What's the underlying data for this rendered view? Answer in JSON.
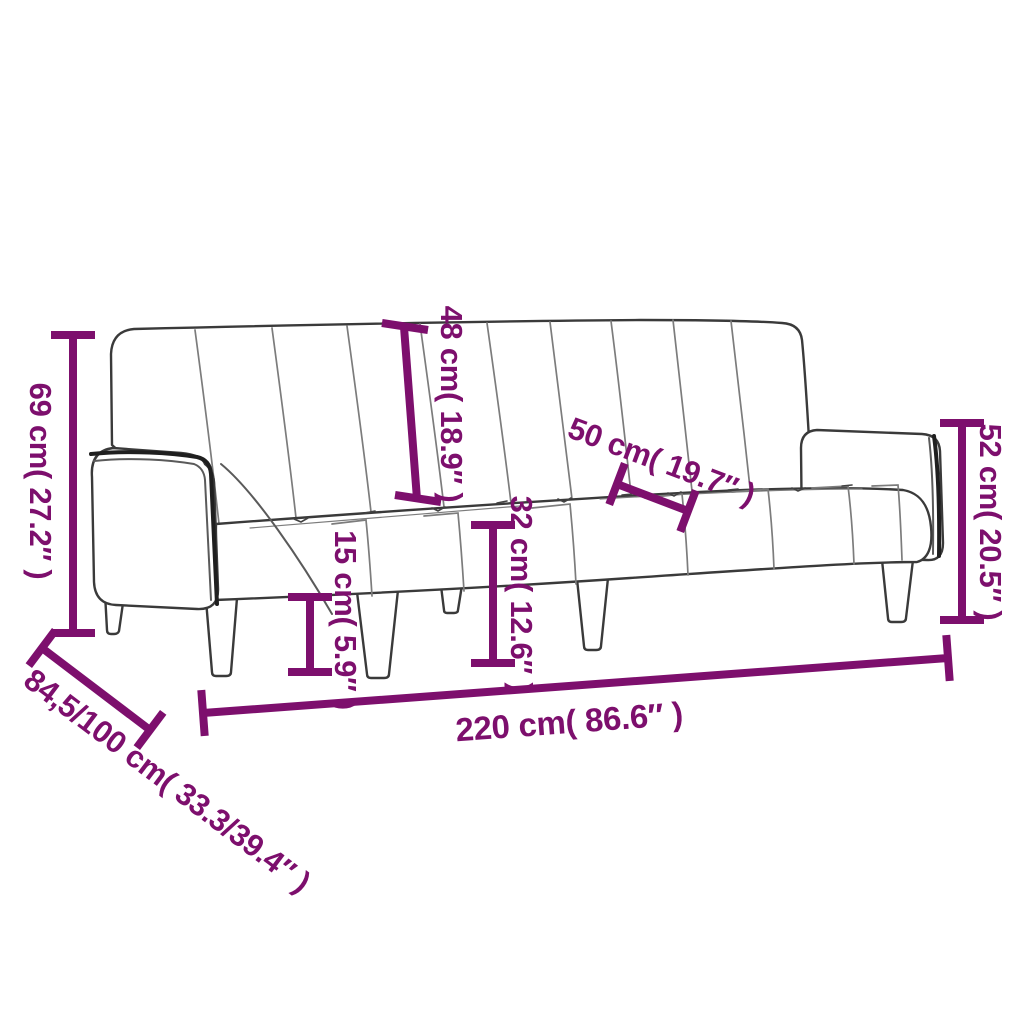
{
  "diagram": {
    "background": "#ffffff",
    "accent_color": "#7D0F6D",
    "sofa_outline_color": "#3a3a3a",
    "sofa_detail_color": "#7c7c7c"
  },
  "dimensions": {
    "dim_69": {
      "label": "69 cm( 27.2″ )"
    },
    "dim_48": {
      "label": "48 cm( 18.9″ )"
    },
    "dim_50": {
      "label": "50 cm( 19.7″ )"
    },
    "dim_52": {
      "label": "52 cm( 20.5″ )"
    },
    "dim_15": {
      "label": "15 cm( 5.9″ )"
    },
    "dim_32": {
      "label": "32 cm( 12.6″ )"
    },
    "dim_220": {
      "label": "220 cm( 86.6″ )"
    },
    "dim_84_100": {
      "label": "84,5/100 cm( 33.3/39.4″ )"
    }
  }
}
